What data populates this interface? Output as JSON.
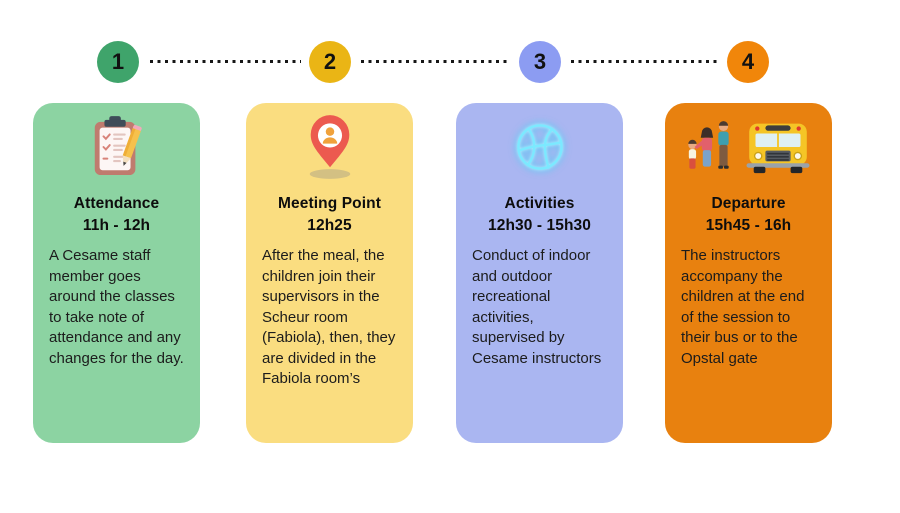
{
  "colors": {
    "background": "#ffffff",
    "body_text": "#1c1c1c",
    "title_text": "#0d0d0d",
    "connector_dots": "#161616"
  },
  "timeline_steps": [
    {
      "number": "1",
      "color": "#3fa46b"
    },
    {
      "number": "2",
      "color": "#eab515"
    },
    {
      "number": "3",
      "color": "#8c9cf2"
    },
    {
      "number": "4",
      "color": "#f1860a"
    }
  ],
  "cards": [
    {
      "title": "Attendance",
      "time": "11h - 12h",
      "body": "A Cesame staff member goes around the classes to take note of attendance and any changes for the day.",
      "bg": "#8cd3a2",
      "icons": [
        "clipboard-checklist-icon"
      ]
    },
    {
      "title": "Meeting Point",
      "time": "12h25",
      "body": "After the meal, the children join their supervisors in the Scheur room (Fabiola), then, they are divided in the Fabiola room’s",
      "bg": "#fadd80",
      "icons": [
        "map-pin-icon"
      ]
    },
    {
      "title": "Activities",
      "time": "12h30 - 15h30",
      "body": "Conduct of indoor and outdoor recreational activities, supervised by Cesame instructors",
      "bg": "#aab6f1",
      "icons": [
        "basketball-icon"
      ]
    },
    {
      "title": "Departure",
      "time": "15h45 - 16h",
      "body": "The instructors accompany the children at the end of the session to their bus or to the Opstal gate",
      "bg": "#e8810f",
      "icons": [
        "family-icon",
        "school-bus-icon"
      ]
    }
  ]
}
